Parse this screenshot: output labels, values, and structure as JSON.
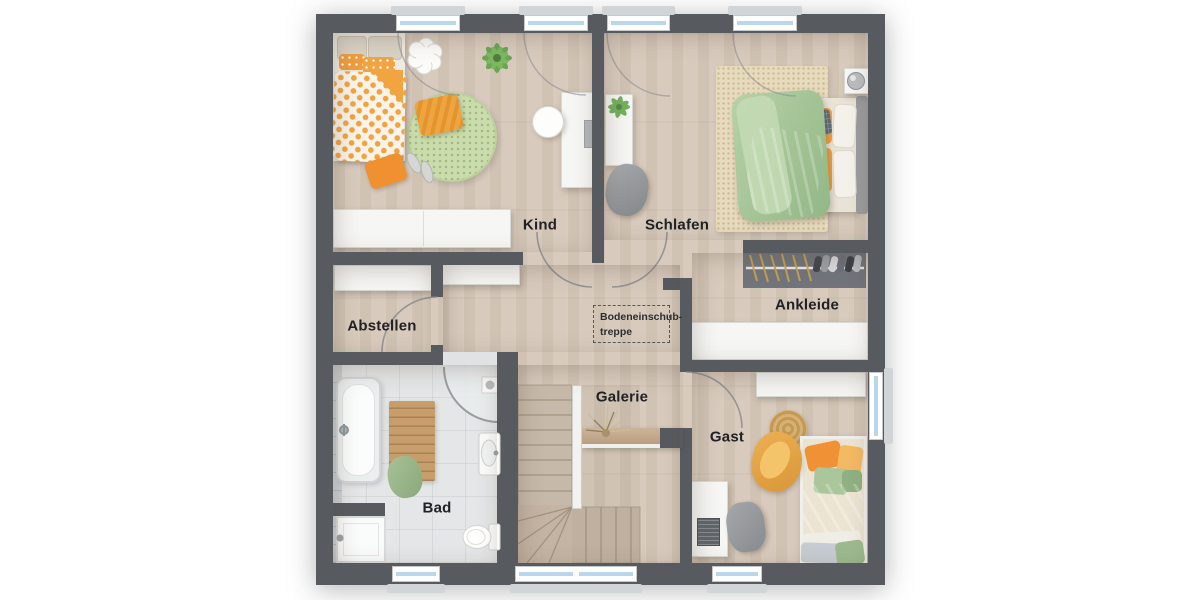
{
  "rooms": [
    {
      "id": "kind",
      "label": "Kind"
    },
    {
      "id": "schlafen",
      "label": "Schlafen"
    },
    {
      "id": "abstellen",
      "label": "Abstellen"
    },
    {
      "id": "ankleide",
      "label": "Ankleide"
    },
    {
      "id": "galerie",
      "label": "Galerie"
    },
    {
      "id": "gast",
      "label": "Gast"
    },
    {
      "id": "bad",
      "label": "Bad"
    }
  ],
  "annotations": {
    "attic_hatch": {
      "line1": "Bodeneinschub-",
      "line2": "treppe"
    }
  },
  "colors": {
    "wall": "#575b60",
    "wood_floor": "#d8cbbd",
    "tile_floor": "#e4e6e7",
    "window_glass": "#b9d6ea",
    "window_frame": "#ffffff",
    "accent_orange": "#f09d3e",
    "rug_green": "#cadcab",
    "duvet_green": "#a8c79a",
    "stair_wood": "#cfc1b1",
    "label_text": "#202124"
  }
}
